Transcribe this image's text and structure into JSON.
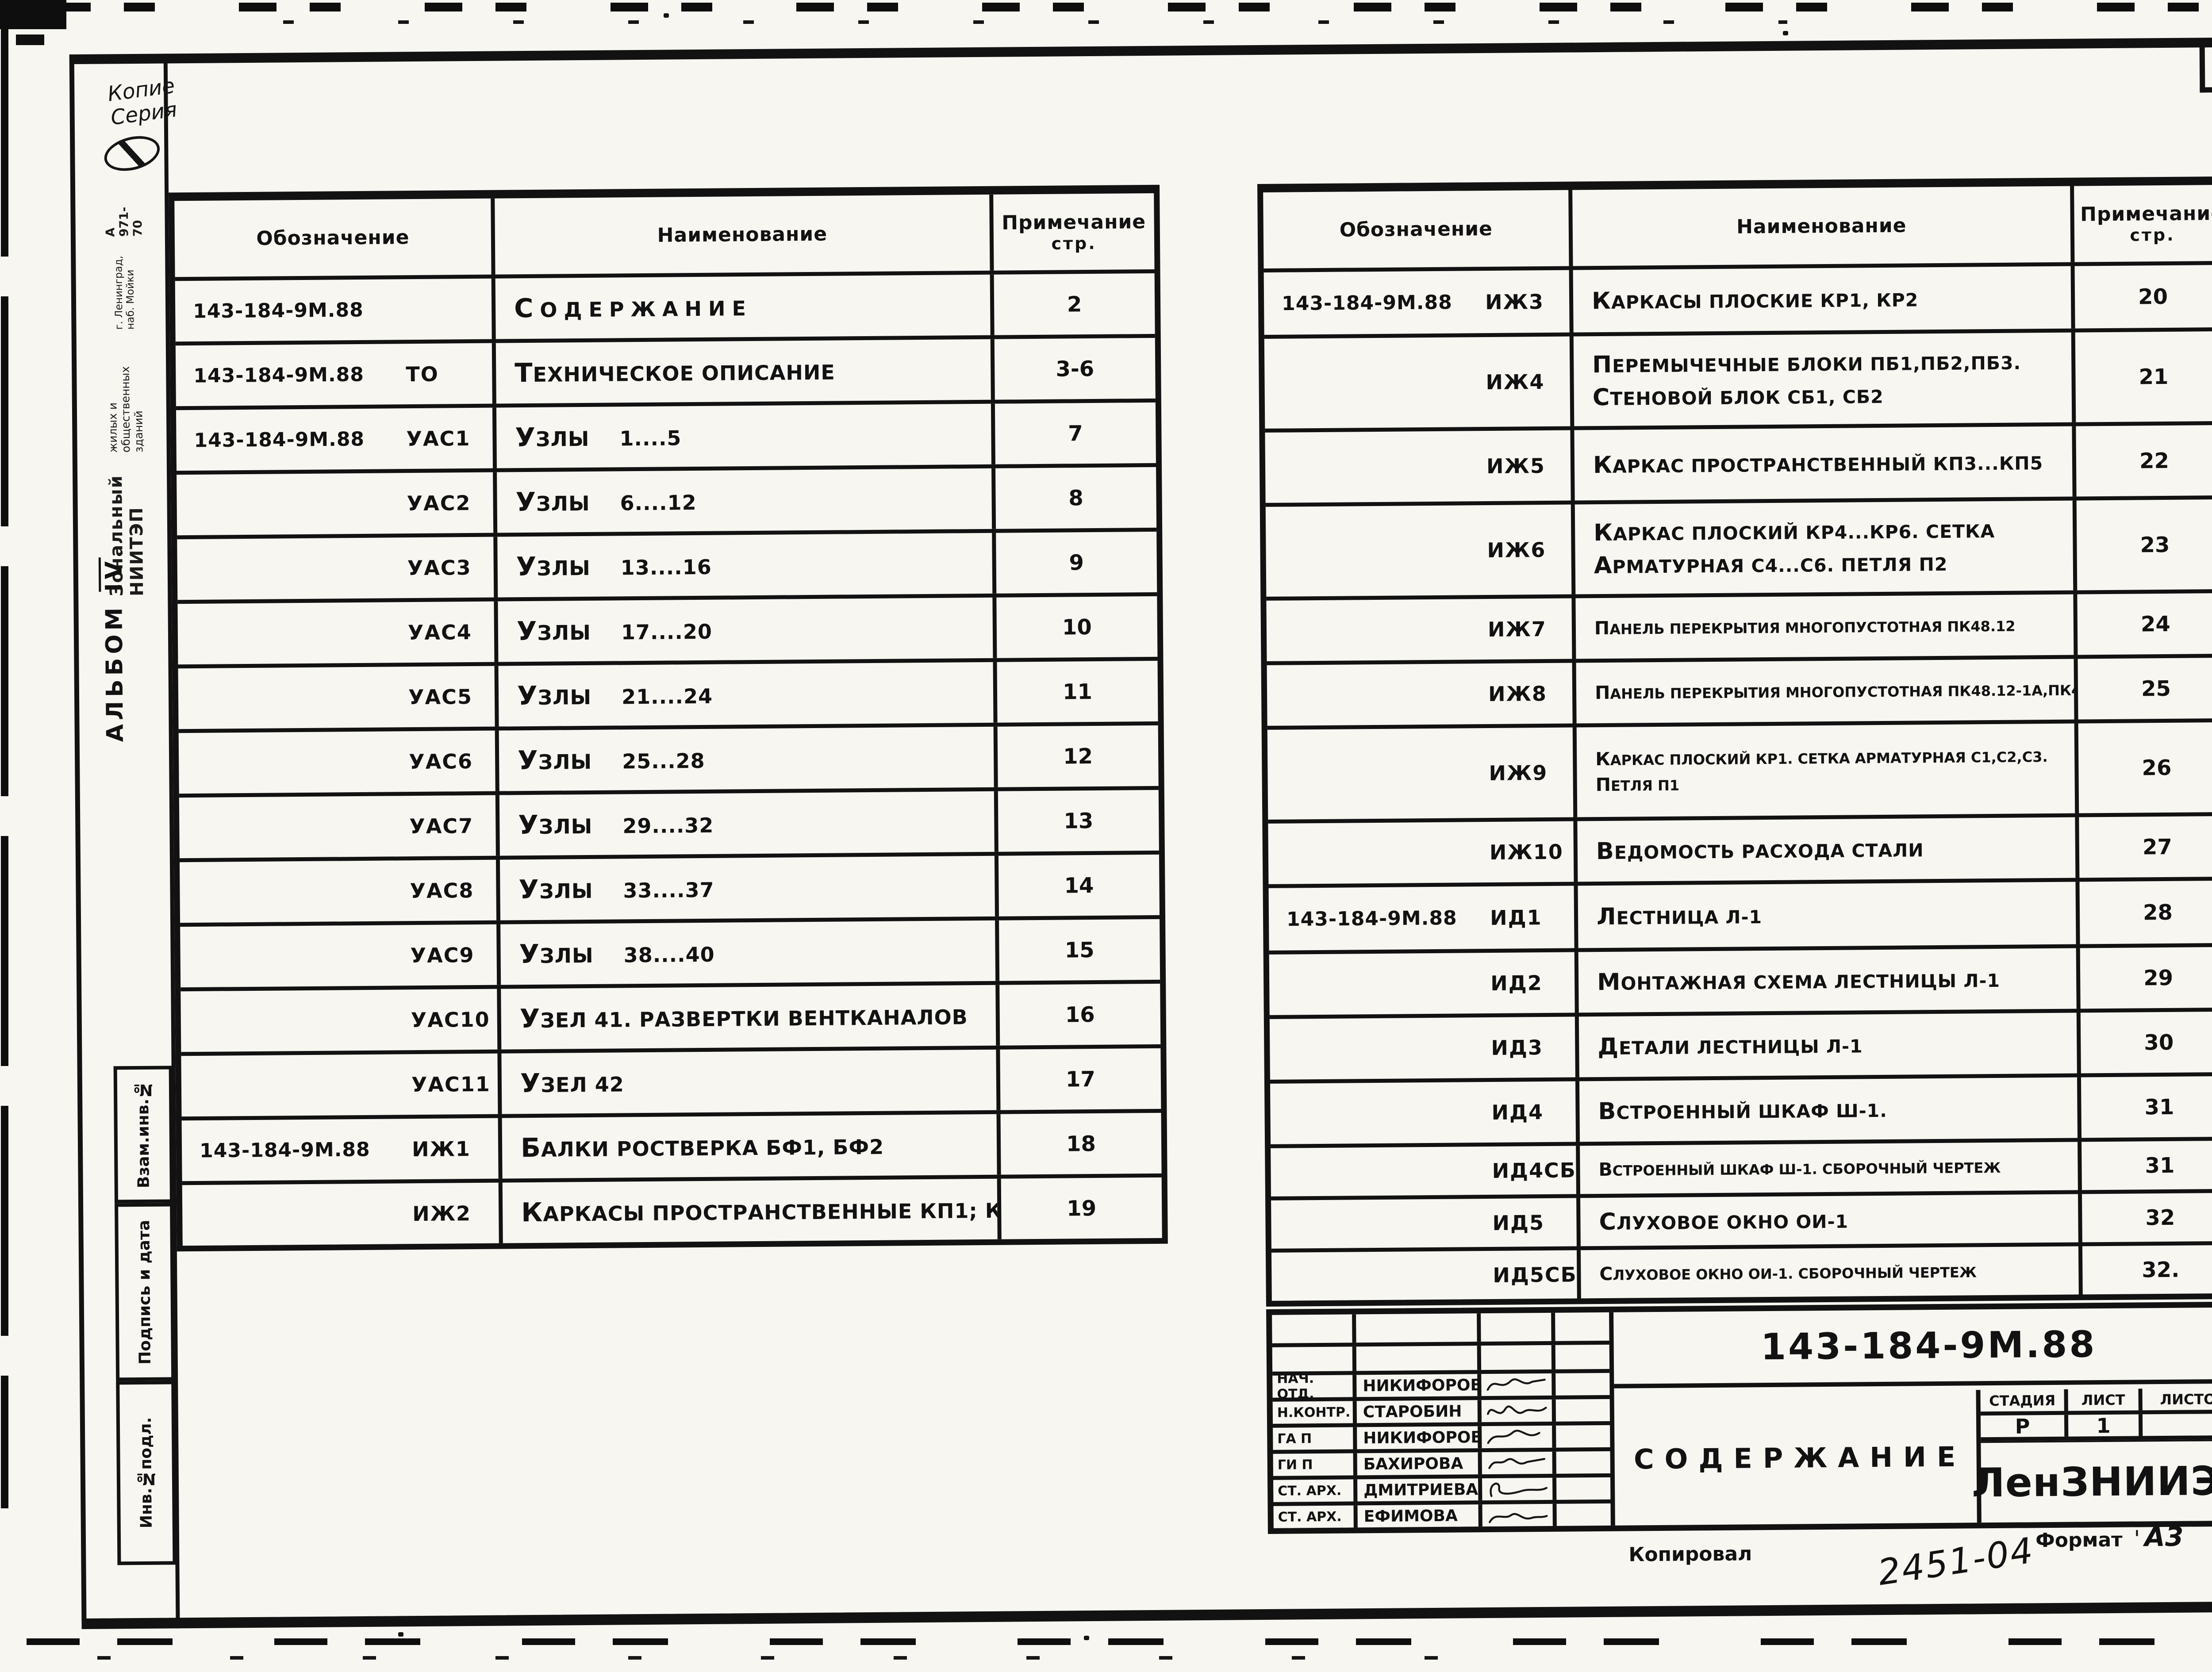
{
  "colors": {
    "ink": "#121212",
    "paper": "#f7f6f1"
  },
  "page": {
    "sheet_number": "2",
    "album_label": "АЛЬБОМ",
    "album_roman": "IV",
    "handwriting_line1": "Копие",
    "handwriting_line2": "Серия",
    "stamp": {
      "line1": "Зональный НИИТЭП",
      "line2": "жилых и общественных зданий",
      "line3": "г. Ленинград, наб. Мойки",
      "line4": "А 971-70"
    },
    "side_labels": [
      "Взам.инв.№",
      "Подпись и дата",
      "Инв.№подл."
    ],
    "footer": {
      "kopiroval": "Копировал",
      "handwritten_number": "2451-04",
      "format_label": "Формат",
      "format_tick": "'",
      "format_value": "А3"
    }
  },
  "table_header": {
    "col1": "Обозначение",
    "col2": "Наименование",
    "col3_line1": "Примечание",
    "col3_line2": "стр."
  },
  "left_table": {
    "rows": [
      {
        "num": "143-184-9М.88",
        "code": "",
        "name": [
          "Содержание"
        ],
        "page": "2",
        "spread": true
      },
      {
        "num": "143-184-9М.88",
        "code": "ТО",
        "name": [
          "Техническое описание"
        ],
        "page": "3-6"
      },
      {
        "num": "143-184-9М.88",
        "code": "УАС1",
        "name": [
          "Узлы    1....5"
        ],
        "page": "7"
      },
      {
        "code": "УАС2",
        "name": [
          "Узлы    6....12"
        ],
        "page": "8"
      },
      {
        "code": "УАС3",
        "name": [
          "Узлы    13....16"
        ],
        "page": "9"
      },
      {
        "code": "УАС4",
        "name": [
          "Узлы    17....20"
        ],
        "page": "10"
      },
      {
        "code": "УАС5",
        "name": [
          "Узлы    21....24"
        ],
        "page": "11"
      },
      {
        "code": "УАС6",
        "name": [
          "Узлы    25...28"
        ],
        "page": "12"
      },
      {
        "code": "УАС7",
        "name": [
          "Узлы    29....32"
        ],
        "page": "13"
      },
      {
        "code": "УАС8",
        "name": [
          "Узлы    33....37"
        ],
        "page": "14"
      },
      {
        "code": "УАС9",
        "name": [
          "Узлы    38....40"
        ],
        "page": "15"
      },
      {
        "code": "УАС10",
        "name": [
          "Узел 41. Развертки вентканалов"
        ],
        "page": "16"
      },
      {
        "code": "УАС11",
        "name": [
          "Узел 42"
        ],
        "page": "17"
      },
      {
        "num": "143-184-9М.88",
        "code": "ИЖ1",
        "name": [
          "Балки ростверка БФ1, БФ2"
        ],
        "page": "18"
      },
      {
        "code": "ИЖ2",
        "name": [
          "Каркасы пространственные КП1; КП2"
        ],
        "page": "19"
      }
    ]
  },
  "right_table": {
    "rows": [
      {
        "num": "143-184-9М.88",
        "code": "ИЖ3",
        "name": [
          "Каркасы плоские КР1, КР2"
        ],
        "page": "20"
      },
      {
        "code": "ИЖ4",
        "name": [
          "Перемычечные блоки ПБ1,ПБ2,ПБ3.",
          "Стеновой блок СБ1, СБ2"
        ],
        "page": "21"
      },
      {
        "code": "ИЖ5",
        "name": [
          "Каркас пространственный КП3...КП5"
        ],
        "page": "22"
      },
      {
        "code": "ИЖ6",
        "name": [
          "Каркас плоский КР4...КР6. Сетка",
          "арматурная С4...С6. Петля П2"
        ],
        "page": "23"
      },
      {
        "code": "ИЖ7",
        "name": [
          "Панель перекрытия многопустотная ПК48.12"
        ],
        "page": "24",
        "compact": true
      },
      {
        "code": "ИЖ8",
        "name": [
          "Панель перекрытия многопустотная ПК48.12-1а,ПК48.12-1б"
        ],
        "page": "25",
        "compact": true
      },
      {
        "code": "ИЖ9",
        "name": [
          "Каркас плоский КР1. Сетка арматурная С1,С2,С3.",
          "Петля П1"
        ],
        "page": "26",
        "compact": true
      },
      {
        "code": "ИЖ10",
        "name": [
          "Ведомость расхода стали"
        ],
        "page": "27"
      },
      {
        "num": "143-184-9М.88",
        "code": "ИД1",
        "name": [
          "Лестница Л-1"
        ],
        "page": "28"
      },
      {
        "code": "ИД2",
        "name": [
          "Монтажная схема лестницы Л-1"
        ],
        "page": "29"
      },
      {
        "code": "ИД3",
        "name": [
          "Детали лестницы Л-1"
        ],
        "page": "30"
      },
      {
        "code": "ИД4",
        "name": [
          "Встроенный шкаф Ш-1."
        ],
        "page": "31"
      },
      {
        "code": "ИД4СБ",
        "name": [
          "Встроенный шкаф Ш-1. Сборочный чертеж"
        ],
        "page": "31",
        "compact": true
      },
      {
        "code": "ИД5",
        "name": [
          "Слуховое окно ОИ-1"
        ],
        "page": "32"
      },
      {
        "code": "ИД5СБ",
        "name": [
          "Слуховое окно ОИ-1. Сборочный чертеж"
        ],
        "page": "32.",
        "compact": true
      }
    ]
  },
  "title_block": {
    "doc_number": "143-184-9М.88",
    "title": "СОДЕРЖАНИЕ",
    "org": "ЛенЗНИИЭП",
    "stage_label": "СТАДИЯ",
    "sheet_label": "ЛИСТ",
    "sheets_label": "ЛИСТОВ",
    "stage_value": "Р",
    "sheet_value": "1",
    "sheets_value": "",
    "staff": [
      {
        "role": "НАЧ. ОТД.",
        "name": "НИКИФОРОВ"
      },
      {
        "role": "Н.КОНТР.",
        "name": "СТАРОБИН"
      },
      {
        "role": "ГА П",
        "name": "НИКИФОРОВ"
      },
      {
        "role": "ГИ П",
        "name": "БАХИРОВА"
      },
      {
        "role": "СТ. АРХ.",
        "name": "ДМИТРИЕВА"
      },
      {
        "role": "СТ. АРХ.",
        "name": "ЕФИМОВА"
      }
    ]
  }
}
